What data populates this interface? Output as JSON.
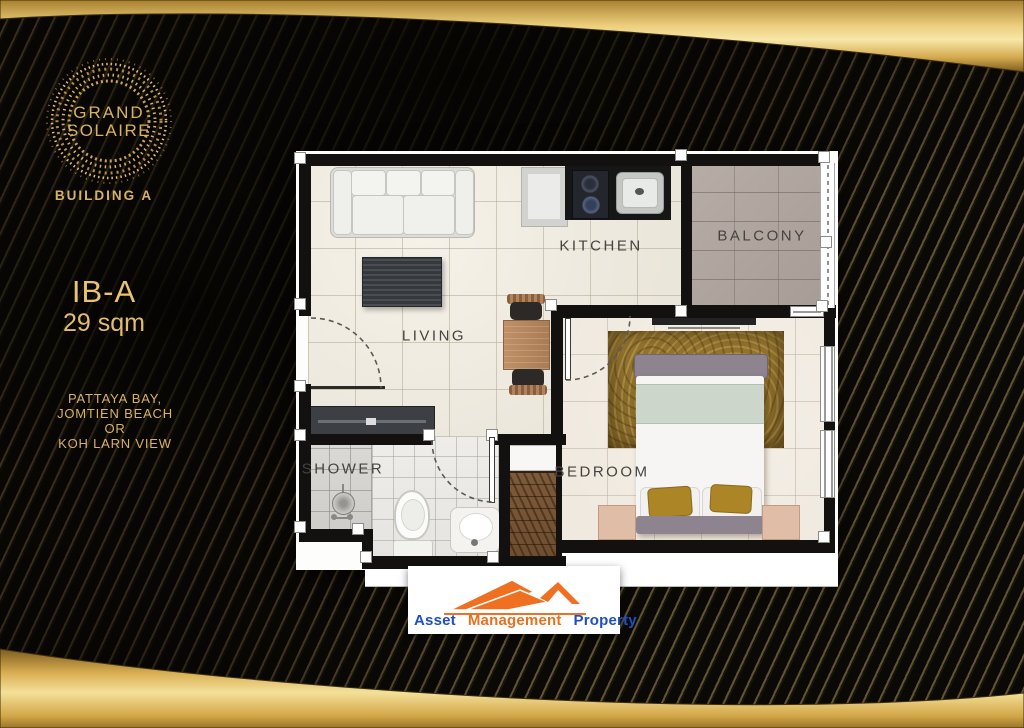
{
  "branding": {
    "logo_top": "GRAND",
    "logo_bottom": "SOLAIRE",
    "building_label": "BUILDING A",
    "unit_code": "IB-A",
    "unit_area": "29 sqm",
    "view_options": [
      "PATTAYA BAY,",
      "JOMTIEN BEACH",
      "OR",
      "KOH LARN VIEW"
    ]
  },
  "floorplan": {
    "labels": {
      "living": "LIVING",
      "kitchen": "KITCHEN",
      "balcony": "BALCONY",
      "bedroom": "BEDROOM",
      "shower": "SHOWER"
    }
  },
  "footer_brand": {
    "words": [
      {
        "text": "Asset",
        "color": "#1e4fc2"
      },
      {
        "text": "Management",
        "color": "#e8701f"
      },
      {
        "text": "Property",
        "color": "#1e4fc2"
      }
    ]
  },
  "colors": {
    "background": "#0b0906",
    "stripe_gold": "#d6ba70",
    "band_gold_bright": "#f7e7a8",
    "band_gold_deep": "#8a6420",
    "gold_text": "#d7b166",
    "brand_blue": "#1e4fc2",
    "brand_orange": "#e8701f"
  }
}
